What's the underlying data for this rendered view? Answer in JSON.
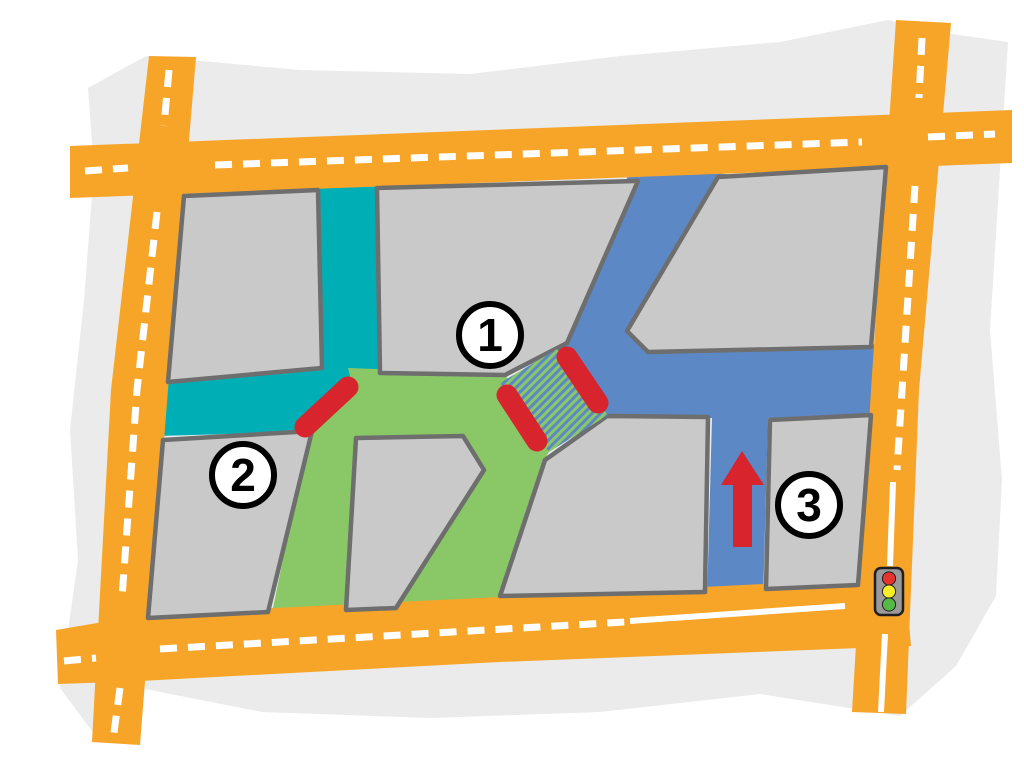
{
  "map": {
    "badges": [
      {
        "id": "badge-1",
        "label": "1"
      },
      {
        "id": "badge-2",
        "label": "2"
      },
      {
        "id": "badge-3",
        "label": "3"
      }
    ],
    "barriers": {
      "count": 3
    },
    "arrow": {
      "direction": "up"
    },
    "hatched_zone": {
      "style": "diagonal-stripes"
    },
    "traffic_light": {
      "lights": [
        "red",
        "yellow",
        "green"
      ]
    }
  },
  "colors": {
    "road": "#F7A528",
    "road_line": "#FFFFFF",
    "map_bg": "#EBEBEB",
    "block_fill": "#C9C9C9",
    "block_border": "#6E6E6E",
    "street_teal": "#00AEB6",
    "street_green": "#8AC767",
    "street_blue": "#5C88C5",
    "barrier_red": "#D8242C",
    "arrow_red": "#D8242C",
    "badge_bg": "#FFFFFF",
    "badge_border": "#000000",
    "signal_body": "#9A9A9A",
    "signal_border": "#1F1F1F",
    "signal_red": "#E5332E",
    "signal_yellow": "#F8EE26",
    "signal_green": "#56B947"
  }
}
